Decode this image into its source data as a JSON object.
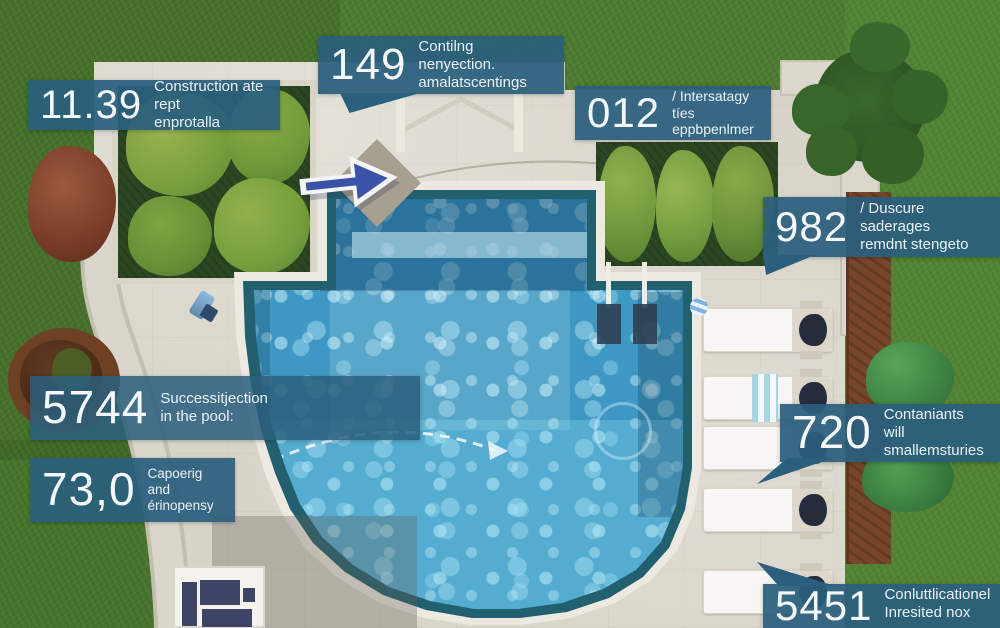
{
  "scene": {
    "title": "pool-aerial-infographic",
    "palette": {
      "callout_navy": "#2a5f7d",
      "water_deep": "#2e7dab",
      "water_light": "#49a5cd",
      "deck": "#d8d4c9",
      "grass": "#4e7d31",
      "mulch": "#78462a",
      "arrow_blue": "#3b53a6"
    },
    "icons": {
      "direction-arrow-icon": "right-arrow",
      "flow-arrow-icon": "curved-dashed-arrow",
      "pool-ladder-icon": "ladder",
      "callout-tail": "triangle-pointer"
    }
  },
  "callouts": [
    {
      "number": "11.39",
      "line1": "Construction ate rept",
      "line2": "enprotalla"
    },
    {
      "number": "149",
      "line1": "Contilng nenyection.",
      "line2": "amalatscentings"
    },
    {
      "number": "012",
      "line1": "/ Intersatagy tíes",
      "line2": "eppbpenlmer"
    },
    {
      "number": "982",
      "line1": "/ Duscure saderages",
      "line2": "remdnt stengeto"
    },
    {
      "number": "5744",
      "line1": "Successitjection",
      "line2": "in the pool:"
    },
    {
      "number": "73,0",
      "line1": "Capoerig and",
      "line2": "érinopensy"
    },
    {
      "number": "720",
      "line1": "Contaniants will",
      "line2": "smallemsturies"
    },
    {
      "number": "5451",
      "line1": "Conluttlicationel",
      "line2": "Inresited nox"
    }
  ]
}
